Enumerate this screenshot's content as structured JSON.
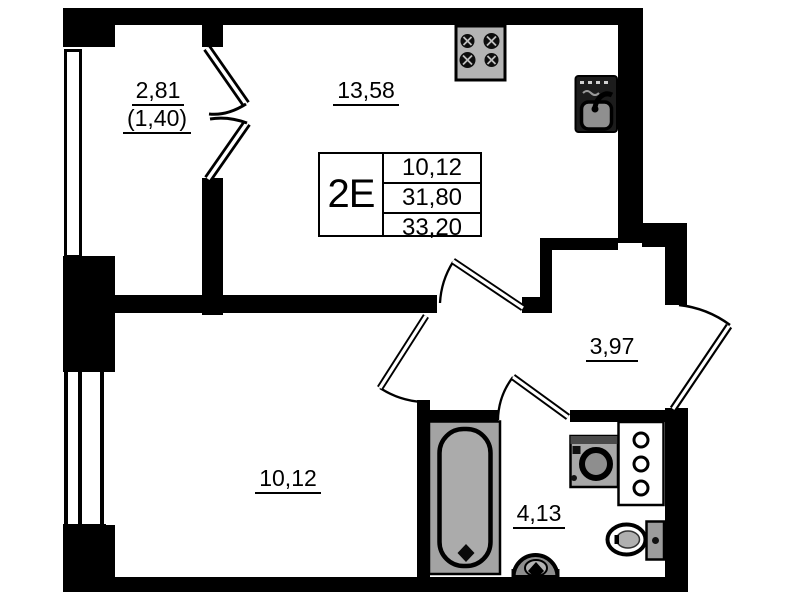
{
  "plan": {
    "title": "apartment-floor-plan",
    "unit": {
      "label": "2E",
      "area_rows": [
        "10,12",
        "31,80",
        "33,20"
      ]
    },
    "rooms": {
      "balcony": {
        "area": "2,81",
        "area_reduced": "(1,40)"
      },
      "kitchen_living": {
        "area": "13,58"
      },
      "hallway": {
        "area": "3,97"
      },
      "bedroom": {
        "area": "10,12"
      },
      "bathroom": {
        "area": "4,13"
      }
    },
    "fixtures": [
      "stove",
      "kitchen-sink",
      "bathtub",
      "washing-machine",
      "utility-shaft",
      "toilet",
      "washbasin"
    ],
    "colors": {
      "wall": "#000000",
      "background": "#ffffff",
      "fixture_gray": "#a3a3a3",
      "fixture_dark": "#1c1c1c"
    }
  }
}
